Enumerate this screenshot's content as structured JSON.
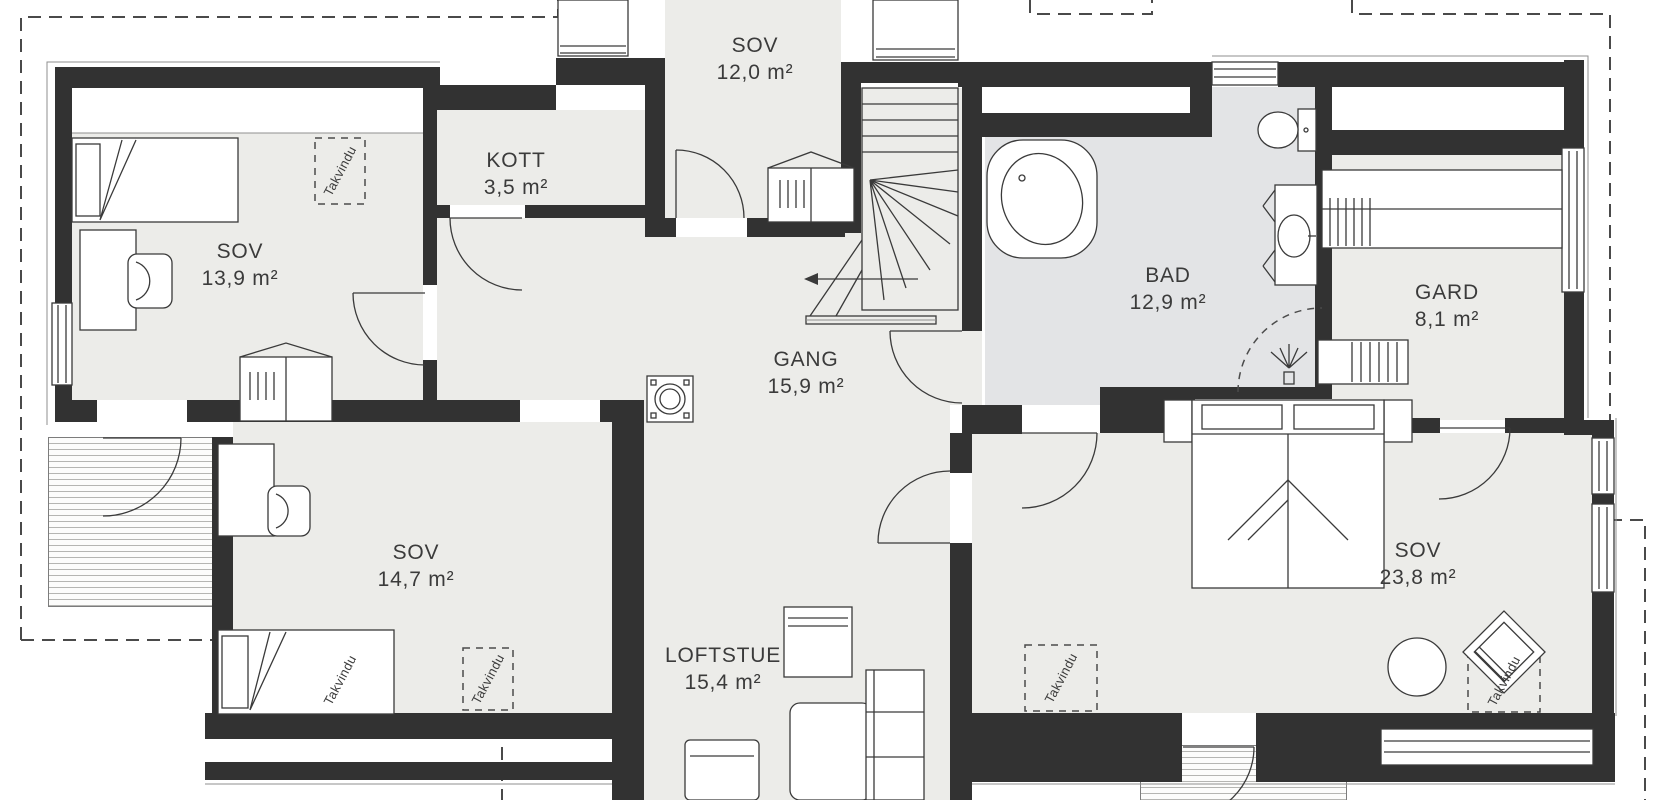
{
  "colors": {
    "wall": "#323232",
    "floor": "#ECECE9",
    "floor_bath": "#E3E4E6",
    "line": "#3a3a3a",
    "dash": "#4a4a4a"
  },
  "rooms": [
    {
      "name": "SOV",
      "area": "13,9 m²"
    },
    {
      "name": "KOTT",
      "area": "3,5 m²"
    },
    {
      "name": "SOV",
      "area": "12,0 m²"
    },
    {
      "name": "GANG",
      "area": "15,9 m²"
    },
    {
      "name": "BAD",
      "area": "12,9 m²"
    },
    {
      "name": "GARD",
      "area": "8,1 m²"
    },
    {
      "name": "SOV",
      "area": "14,7 m²"
    },
    {
      "name": "LOFTSTUE",
      "area": "15,4 m²"
    },
    {
      "name": "SOV",
      "area": "23,8 m²"
    }
  ],
  "annotations": {
    "roof_window_label": "Takvindu"
  }
}
